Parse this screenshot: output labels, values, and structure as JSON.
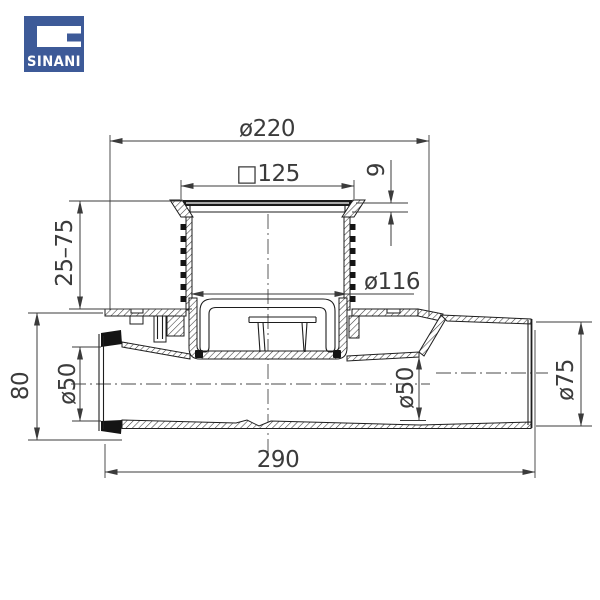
{
  "brand": {
    "name": "SINANI",
    "logo_color": "#3d5a98"
  },
  "drawing": {
    "type": "floor-drain cross-section technical drawing",
    "line_color": "#1e1e1e",
    "dimension_color": "#3b3b3b",
    "dimensions": {
      "top_flange_diameter": "ø220",
      "grate_square_size": "□125",
      "grate_frame_height": "9",
      "adjustable_height_range": "25–75",
      "body_inner_diameter": "ø116",
      "inlet_height": "80",
      "inlet_diameter": "ø50",
      "outlet_bore_diameter": "ø50",
      "outlet_outer_diameter": "ø75",
      "overall_length": "290"
    }
  }
}
